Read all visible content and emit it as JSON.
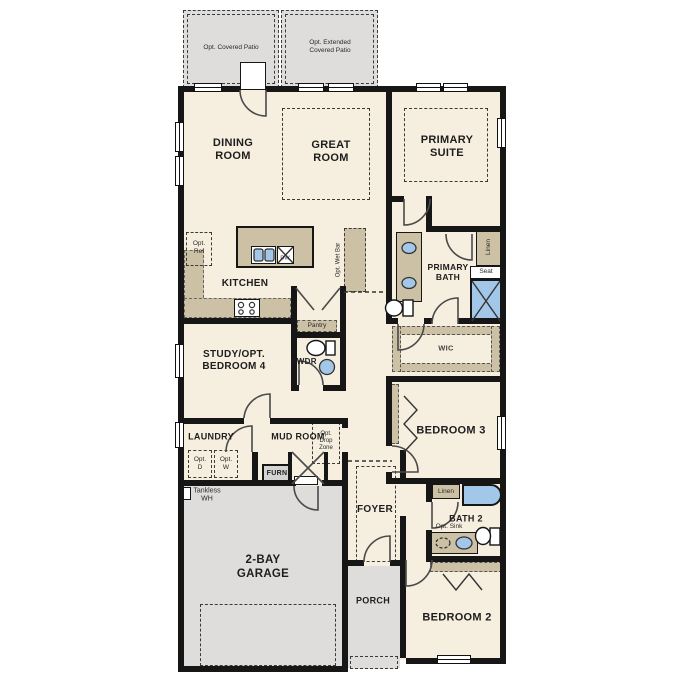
{
  "colors": {
    "floor": "#f6efdf",
    "outdoor": "#dedddb",
    "counter_tan": "#cdc1a5",
    "fixture_blue": "#a3c7e8",
    "wall": "#161616"
  },
  "rooms": {
    "covered_patio": "Opt. Covered Patio",
    "extended_patio": "Opt. Extended\nCovered Patio",
    "dining": "DINING\nROOM",
    "great": "GREAT\nROOM",
    "primary_suite": "PRIMARY\nSUITE",
    "kitchen": "KITCHEN",
    "primary_bath": "PRIMARY\nBATH",
    "wic": "WIC",
    "study": "STUDY/OPT.\nBEDROOM 4",
    "pwdr": "PWDR",
    "laundry": "LAUNDRY",
    "mud_room": "MUD ROOM",
    "bedroom3": "BEDROOM 3",
    "foyer": "FOYER",
    "bath2": "BATH 2",
    "bedroom2": "BEDROOM 2",
    "garage": "2-BAY\nGARAGE",
    "porch": "PORCH"
  },
  "features": {
    "opt_ref": "Opt.\nRef",
    "dw": "DW",
    "pantry": "Pantry",
    "opt_wet_bar": "Opt. Wet Bar",
    "linen_primary": "Linen",
    "seat": "Seat",
    "opt_d": "Opt.\nD",
    "opt_w": "Opt.\nW",
    "opt_drop_zone": "Opt.\nDrop\nZone",
    "furn": "FURN",
    "tankless_wh": "Tankless\nWH",
    "linen_bath2": "Linen",
    "opt_sink": "Opt. Sink"
  }
}
